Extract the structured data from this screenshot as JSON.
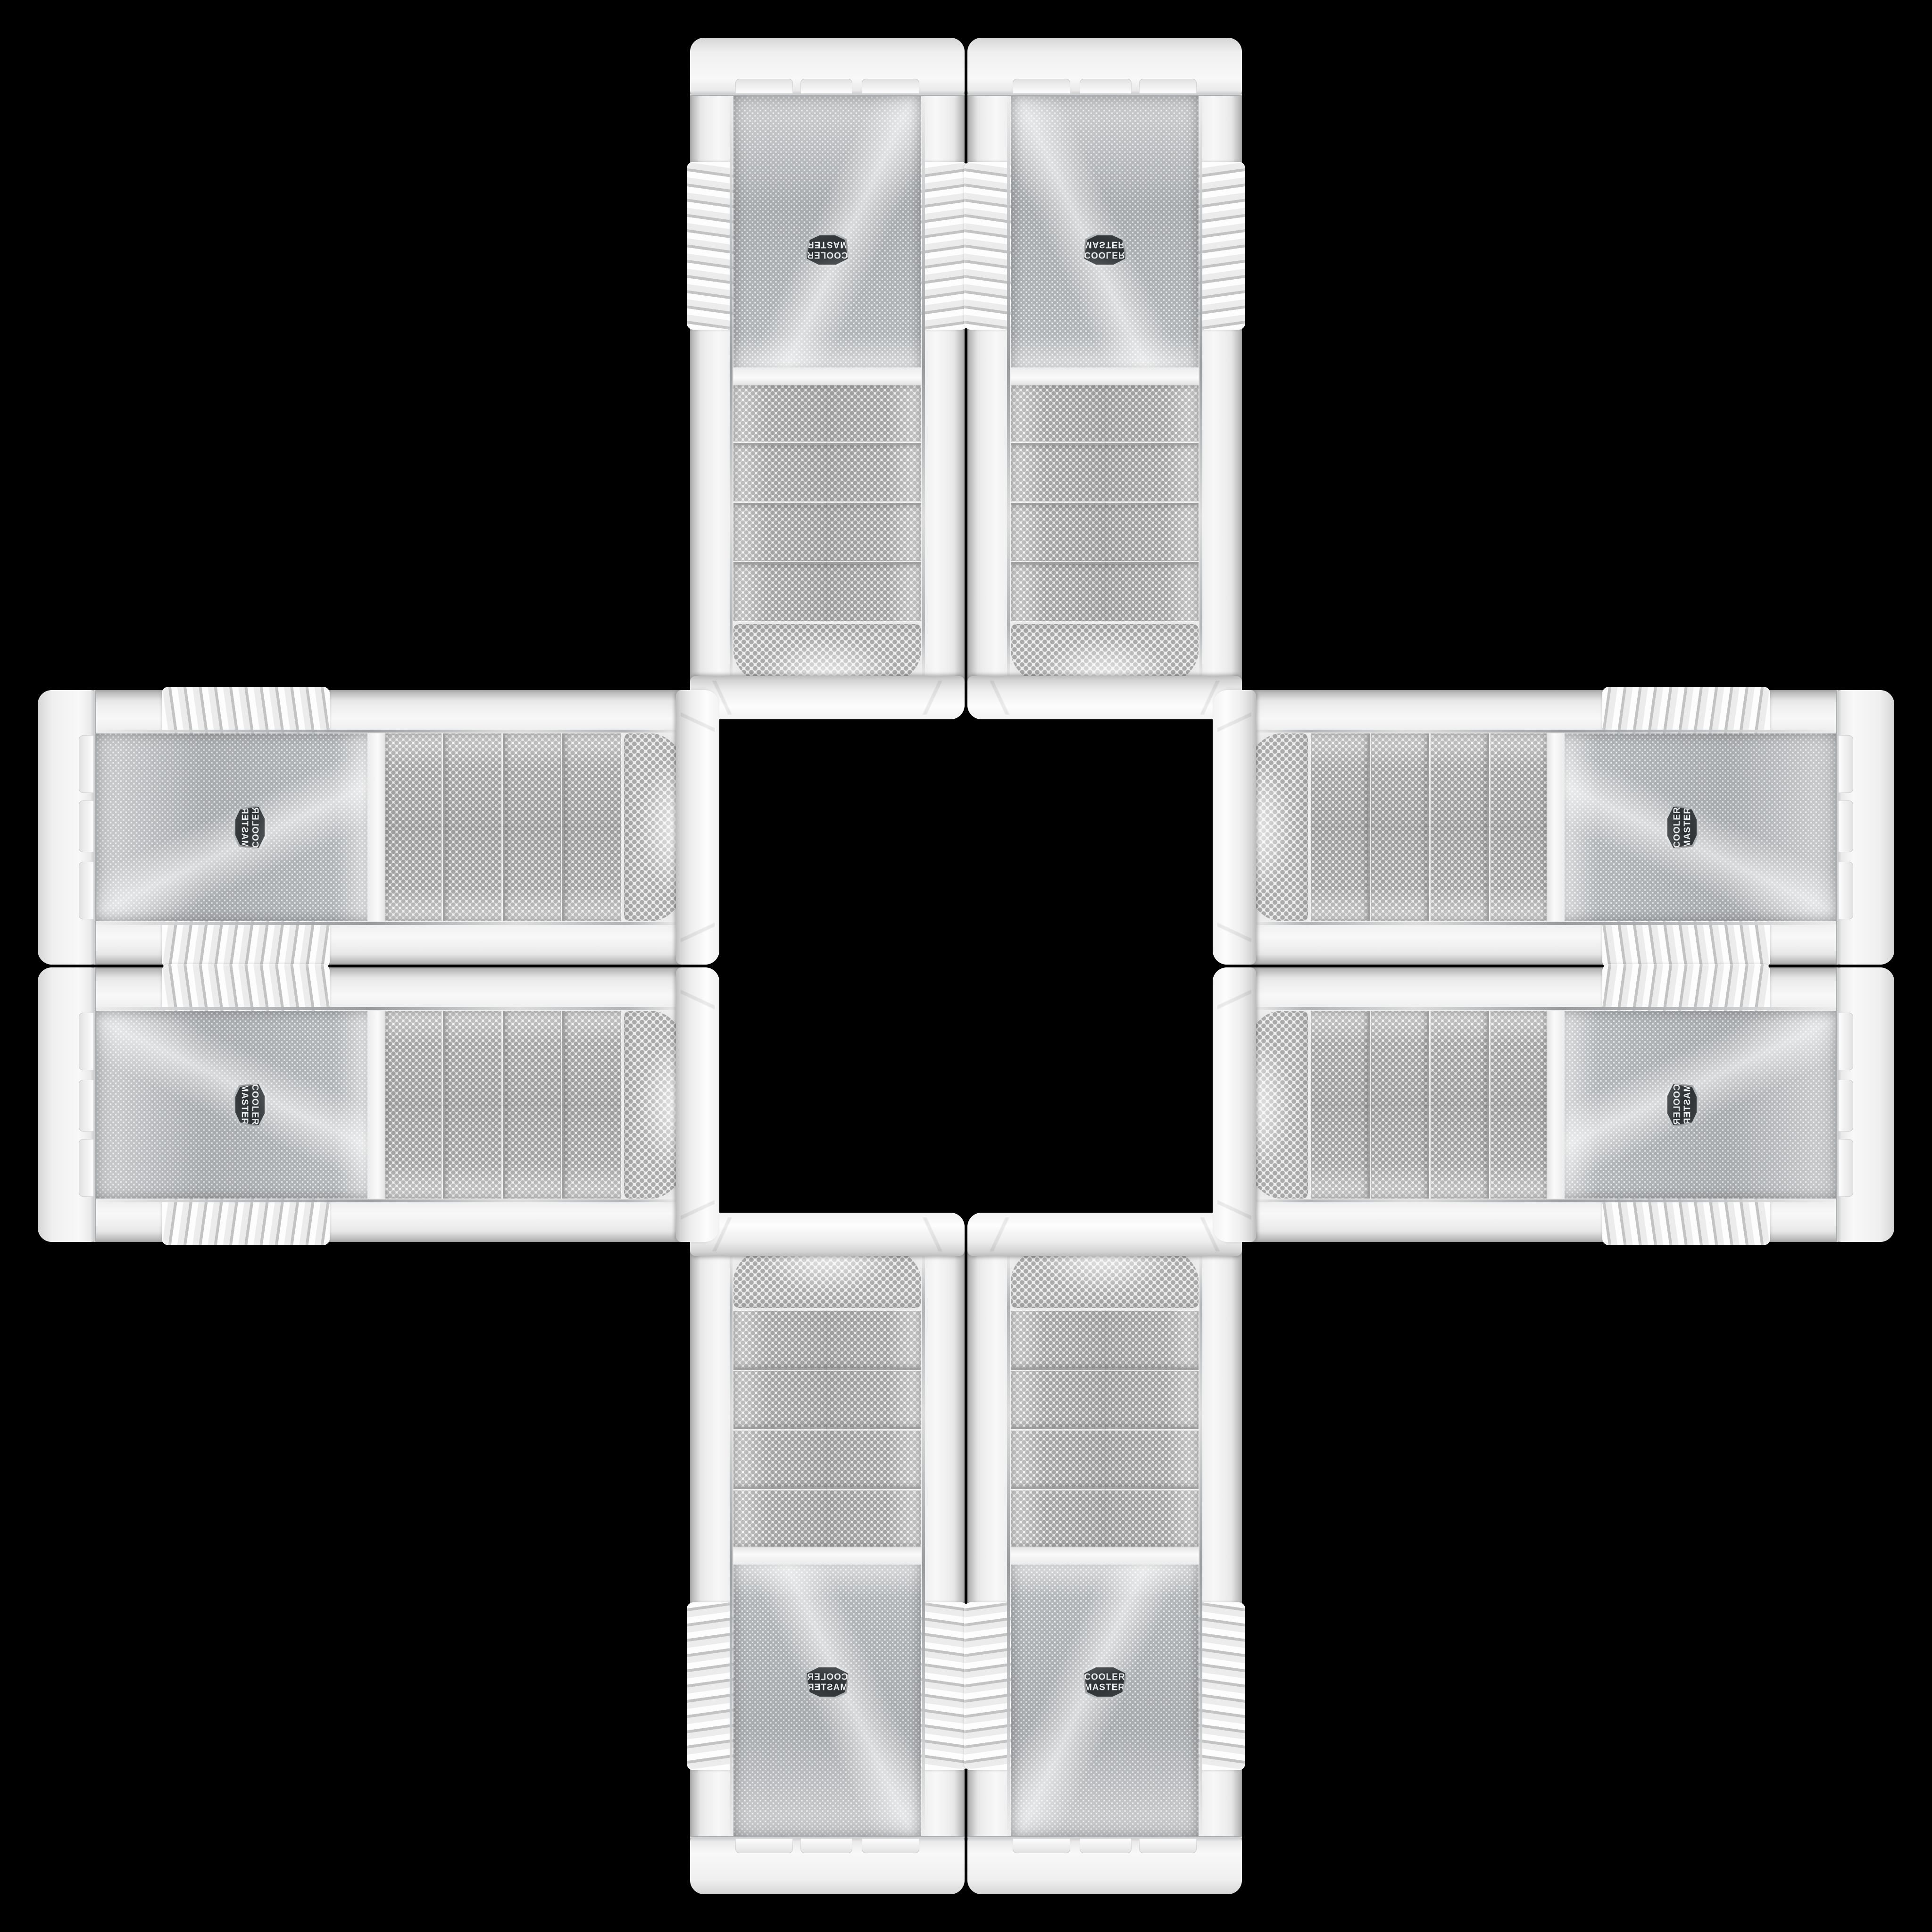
{
  "brand": {
    "line1": "COOLER",
    "line2": "MASTER"
  },
  "badge": {
    "text": "COOLER MASTER"
  },
  "colors": {
    "background": "#000000",
    "panel_white": "#f1f1f1",
    "panel_shadow": "#bcbcbc",
    "mesh_dot_gray": "#a8acaf",
    "chrome_trim": "#b9bdc0",
    "badge_background": "#35383b",
    "badge_ring": "#c9cbcc",
    "badge_text": "#e8eaeb"
  },
  "panels": [
    {
      "name": "case-panel-top-left",
      "orientation": "vertical",
      "mirrored": "rotated-180"
    },
    {
      "name": "case-panel-top-right",
      "orientation": "vertical",
      "mirrored": "flipped-vertical"
    },
    {
      "name": "case-panel-bottom-left",
      "orientation": "vertical",
      "mirrored": "flipped-horizontal"
    },
    {
      "name": "case-panel-bottom-right",
      "orientation": "vertical",
      "mirrored": "none"
    },
    {
      "name": "case-panel-left-top",
      "orientation": "horizontal",
      "mirrored": "rotated-90-flipped"
    },
    {
      "name": "case-panel-left-bottom",
      "orientation": "horizontal",
      "mirrored": "rotated-90"
    },
    {
      "name": "case-panel-right-top",
      "orientation": "horizontal",
      "mirrored": "rotated-270"
    },
    {
      "name": "case-panel-right-bottom",
      "orientation": "horizontal",
      "mirrored": "rotated-270-flipped"
    }
  ]
}
